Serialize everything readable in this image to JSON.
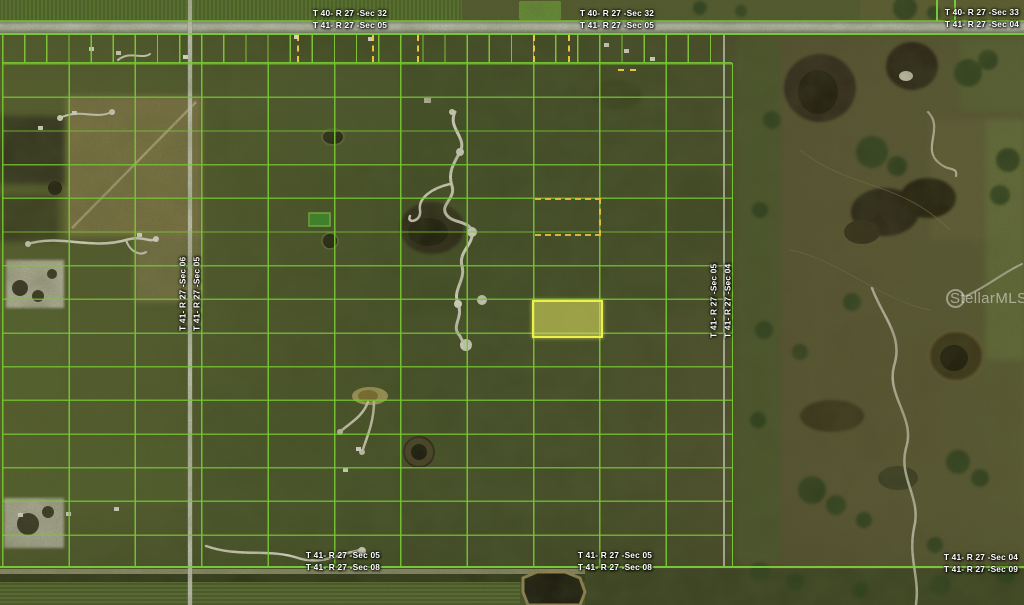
{
  "watermark": {
    "text": "StellarMLS"
  },
  "colors": {
    "parcel_grid": "#76c832",
    "highlight_fill": "#e1e15f",
    "highlight_border": "#eef04a",
    "dashed_marker": "#f0c03e",
    "road": "#ced2c6"
  },
  "labels": {
    "north_center": {
      "upper": "T 40- R 27 -Sec 32",
      "lower": "T 41- R 27 -Sec 05"
    },
    "north_east": {
      "upper": "T 40- R 27 -Sec 32",
      "lower": "T 41- R 27 -Sec 05"
    },
    "north_far_east": {
      "upper": "T 40- R 27 -Sec 33",
      "lower": "T 41- R 27 -Sec 04"
    },
    "west_line": {
      "left": "T 41- R 27 -Sec 06",
      "right": "T 41- R 27 -Sec 05"
    },
    "east_line": {
      "left": "T 41- R 27 -Sec 05",
      "right": "T 41- R 27 -Sec 04"
    },
    "south_center": {
      "upper": "T 41- R 27 -Sec 05",
      "lower": "T 41- R 27 -Sec 08"
    },
    "south_east": {
      "upper": "T 41- R 27 -Sec 05",
      "lower": "T 41- R 27 -Sec 08"
    },
    "south_far_east": {
      "upper": "T 41- R 27 -Sec 04",
      "lower": "T 41- R 27 -Sec 09"
    }
  }
}
